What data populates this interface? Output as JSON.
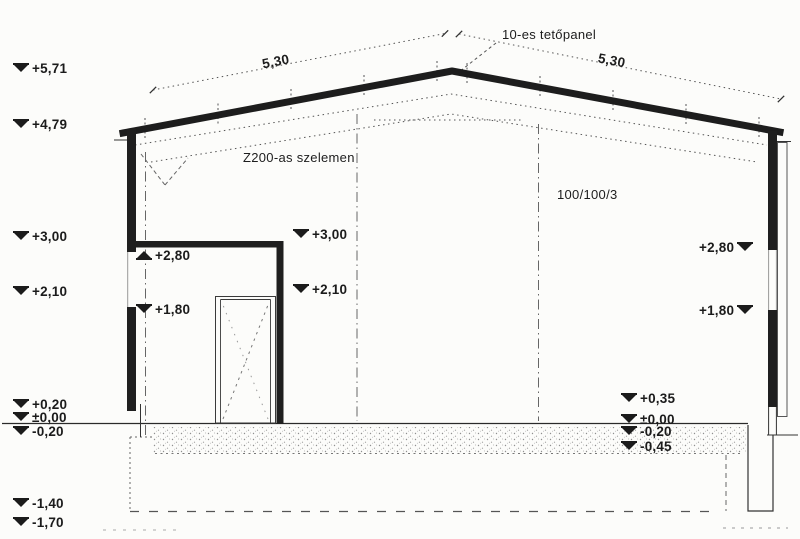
{
  "meta": {
    "drawing_type": "building cross-section (scanned architectural drawing)",
    "language": "Hungarian"
  },
  "colors": {
    "paper": "#fcfcfa",
    "ink": "#1b1b1b",
    "line": "#333333",
    "dotted": "#555555"
  },
  "annotations": {
    "roof_panel_label": "10-es tetőpanel",
    "purlin_label": "Z200-as szelemen",
    "column_label": "100/100/3",
    "roof_dim_left": "5,30",
    "roof_dim_right": "5,30"
  },
  "elevation_markers": [
    {
      "label": "+5,71",
      "x": 14,
      "y": 61,
      "tri": "down",
      "side": "left"
    },
    {
      "label": "+4,79",
      "x": 14,
      "y": 117,
      "tri": "down",
      "side": "left"
    },
    {
      "label": "+3,00",
      "x": 14,
      "y": 229,
      "tri": "down",
      "side": "left"
    },
    {
      "label": "+2,10",
      "x": 14,
      "y": 284,
      "tri": "down",
      "side": "left"
    },
    {
      "label": "+0,20",
      "x": 14,
      "y": 397,
      "tri": "down",
      "side": "left"
    },
    {
      "label": "±0,00",
      "x": 14,
      "y": 410,
      "tri": "down",
      "side": "left"
    },
    {
      "label": "-0,20",
      "x": 14,
      "y": 424,
      "tri": "down",
      "side": "left"
    },
    {
      "label": "-1,40",
      "x": 14,
      "y": 496,
      "tri": "down",
      "side": "left"
    },
    {
      "label": "-1,70",
      "x": 14,
      "y": 515,
      "tri": "down",
      "side": "left"
    },
    {
      "label": "+2,80",
      "x": 137,
      "y": 248,
      "tri": "up",
      "side": "left"
    },
    {
      "label": "+1,80",
      "x": 137,
      "y": 302,
      "tri": "down",
      "side": "left"
    },
    {
      "label": "+3,00",
      "x": 294,
      "y": 227,
      "tri": "down",
      "side": "left"
    },
    {
      "label": "+2,10",
      "x": 294,
      "y": 282,
      "tri": "down",
      "side": "left"
    },
    {
      "label": "+2,80",
      "x": 699,
      "y": 240,
      "tri": "down",
      "side": "right"
    },
    {
      "label": "+1,80",
      "x": 699,
      "y": 303,
      "tri": "down",
      "side": "right"
    },
    {
      "label": "+0,35",
      "x": 622,
      "y": 391,
      "tri": "down",
      "side": "left"
    },
    {
      "label": "±0,00",
      "x": 622,
      "y": 412,
      "tri": "down",
      "side": "left"
    },
    {
      "label": "-0,20",
      "x": 622,
      "y": 424,
      "tri": "down",
      "side": "left"
    },
    {
      "label": "-0,45",
      "x": 622,
      "y": 439,
      "tri": "down",
      "side": "left"
    }
  ]
}
